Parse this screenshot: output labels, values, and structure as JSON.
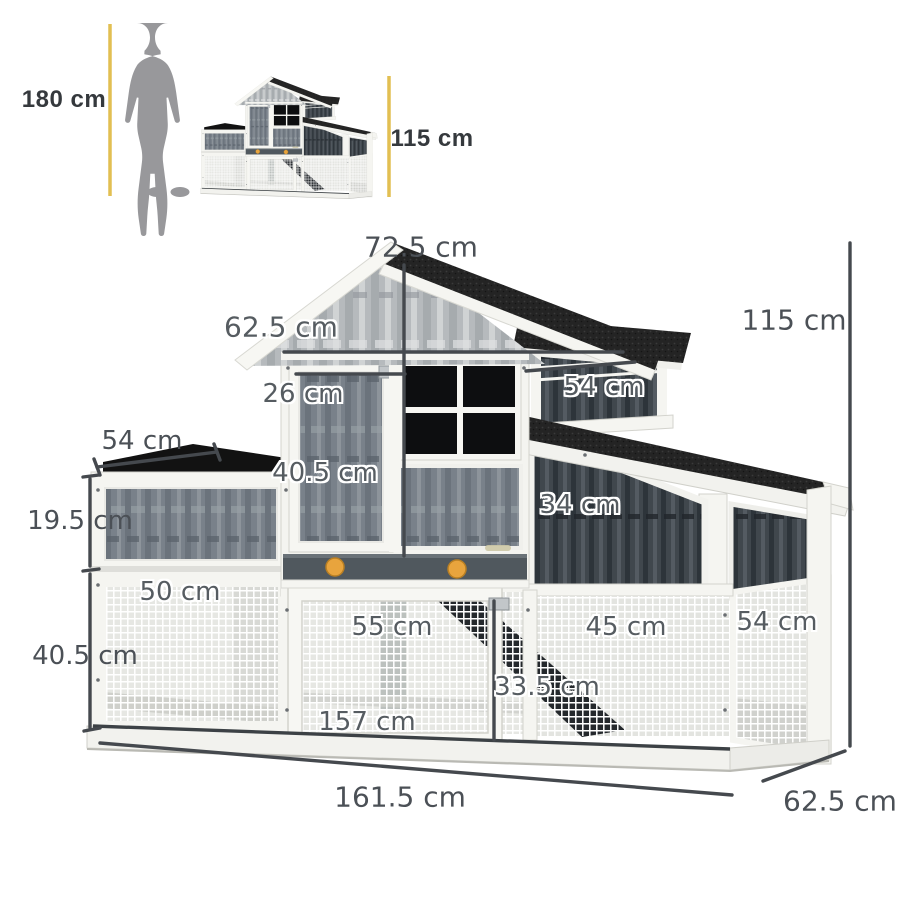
{
  "size_comparison": {
    "person_height_label": "180 cm",
    "product_height_label": "115 cm"
  },
  "dimension_labels": {
    "peak_height": "72.5 cm",
    "upper_roof_width": "62.5 cm",
    "house_door_width": "26 cm",
    "nest_box_width": "54 cm",
    "overall_height": "115 cm",
    "planter_width": "54 cm",
    "house_door_height": "40.5 cm",
    "right_panel_height": "34 cm",
    "planter_height": "19.5 cm",
    "left_run_width": "50 cm",
    "center_door_width": "55 cm",
    "right_run_width": "45 cm",
    "side_depth": "54 cm",
    "run_height": "40.5 cm",
    "ramp_door_height": "33.5 cm",
    "inner_width": "157 cm",
    "overall_width": "161.5 cm",
    "overall_depth": "62.5 cm"
  },
  "colors": {
    "accent_yellow": "#E2BF52",
    "dimension_line": "#45494E",
    "label_text": "#4B5056",
    "roof_black": "#242424",
    "wood_gray": "#79818A",
    "knob_orange": "#E8A43D",
    "silhouette_gray": "#98989B"
  }
}
